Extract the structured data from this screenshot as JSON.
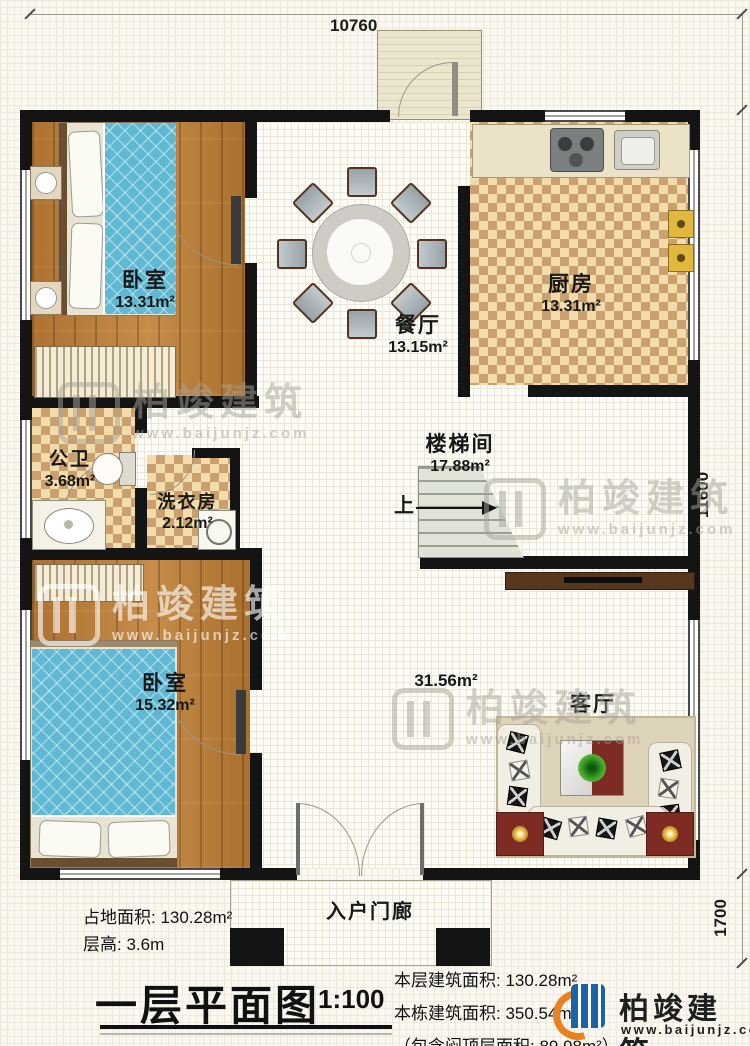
{
  "watermark": {
    "brand": "柏竣建筑",
    "url": "www.baijunjz.com"
  },
  "dimensions": {
    "top": "10760",
    "right": "11600",
    "bottom_right": "1700"
  },
  "rooms": {
    "bedroom1": {
      "name": "卧室",
      "area": "13.31m²"
    },
    "dining": {
      "name": "餐厅",
      "area": "13.15m²"
    },
    "kitchen": {
      "name": "厨房",
      "area": "13.31m²"
    },
    "bath": {
      "name": "公卫",
      "area": "3.68m²"
    },
    "laundry": {
      "name": "洗衣房",
      "area": "2.12m²"
    },
    "stairwell": {
      "name": "楼梯间",
      "area": "17.88m²",
      "up_label": "上"
    },
    "bedroom2": {
      "name": "卧室",
      "area": "15.32m²"
    },
    "living": {
      "name": "客厅",
      "area": "31.56m²"
    },
    "entry_porch": {
      "name": "入户门廊"
    }
  },
  "notes": {
    "land_area_label": "占地面积: 130.28m²",
    "floor_height_label": "层高: 3.6m"
  },
  "titleblock": {
    "title": "一层平面图",
    "scale": "1:100",
    "floor_area": "本层建筑面积: 130.28m²",
    "building_area": "本栋建筑面积: 350.54m²",
    "attic_note": "（包含闷顶层面积: 89.98m²）",
    "brand": "柏竣建筑",
    "brand_url": "www.baijunjz.com"
  },
  "colors": {
    "wall": "#141414",
    "wood_floor": "#b57b3b",
    "tile_light": "#f2dcab",
    "tile_dark": "#c9a06e",
    "bed_blue": "#5fb9d3",
    "accent_red": "#7e2b24",
    "logo_blue": "#1b63a8",
    "logo_orange": "#e8821e"
  }
}
